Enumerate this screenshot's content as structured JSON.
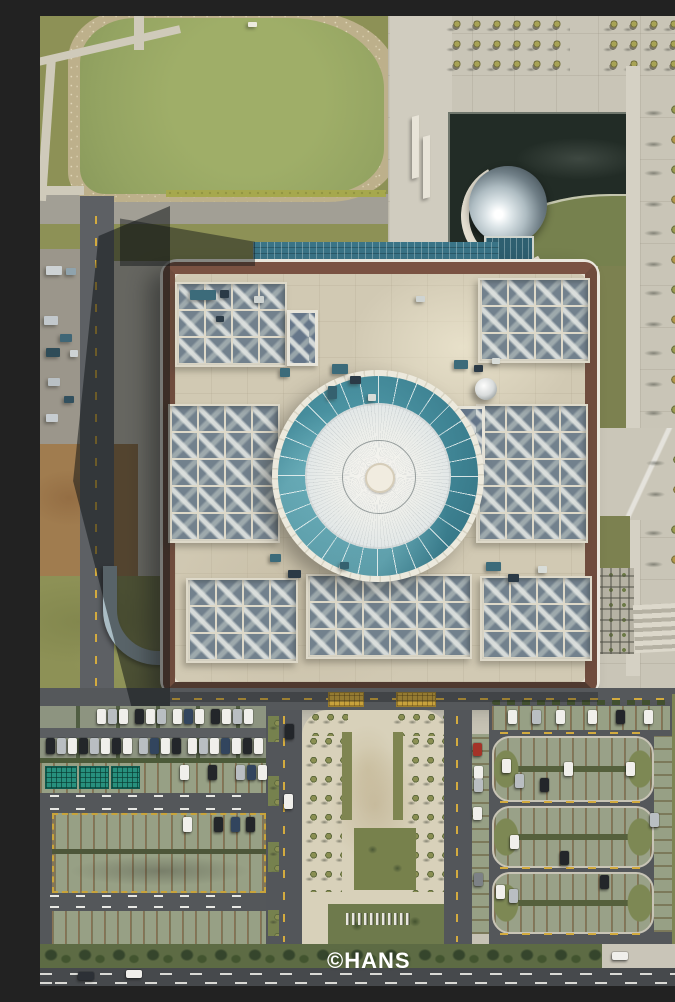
{
  "meta": {
    "type": "aerial-drone-photograph",
    "view": "top-down",
    "description": "Top-down aerial photograph of a large square museum building with a circular teal glass ring and white domed skylight at its center, a mirrored sphere in a dark reflecting pool at its north-east corner, a green pond to the north-west, tree-lined plazas, and large parking lots with grass-paver stalls to the south.",
    "width_px": 675,
    "height_px": 970
  },
  "watermark": {
    "text": "©HANS",
    "color": "#ffffff"
  },
  "palette": {
    "pond_green": "#9aa865",
    "grass_olive": "#8a8f56",
    "plaza_light": "#cbc7b9",
    "roof_beige": "#d0c8b2",
    "parapet_brown": "#5e4338",
    "dome_teal": "#3d7f8e",
    "dome_white": "#edeeea",
    "pool_dark": "#222c26",
    "sphere_silver": "#c3ced3",
    "asphalt_gray": "#54575a",
    "paver_green_gray": "#98a086",
    "stripe_pink": "#c48870",
    "hedge_dark_green": "#4c5a39",
    "autumn_tree_gold": "#b3974a",
    "road_marking_yellow": "#d3ab3f",
    "road_marking_white": "#e8e8e4"
  },
  "scene": {
    "cars": [
      [
        57,
        693,
        9,
        15,
        "#f0efeb"
      ],
      [
        68,
        693,
        9,
        15,
        "#b9bec2"
      ],
      [
        79,
        693,
        9,
        15,
        "#f0efeb"
      ],
      [
        95,
        693,
        9,
        15,
        "#23262a"
      ],
      [
        106,
        693,
        9,
        15,
        "#f0efeb"
      ],
      [
        117,
        693,
        9,
        15,
        "#b9bec2"
      ],
      [
        133,
        693,
        9,
        15,
        "#f0efeb"
      ],
      [
        144,
        693,
        9,
        15,
        "#32455e"
      ],
      [
        155,
        693,
        9,
        15,
        "#f0efeb"
      ],
      [
        171,
        693,
        9,
        15,
        "#23262a"
      ],
      [
        182,
        693,
        9,
        15,
        "#f0efeb"
      ],
      [
        193,
        693,
        9,
        15,
        "#b9bec2"
      ],
      [
        204,
        693,
        9,
        15,
        "#f0efeb"
      ],
      [
        6,
        722,
        9,
        16,
        "#23262a"
      ],
      [
        17,
        722,
        9,
        16,
        "#b9bec2"
      ],
      [
        28,
        722,
        9,
        16,
        "#f0efeb"
      ],
      [
        39,
        722,
        9,
        16,
        "#23262a"
      ],
      [
        50,
        722,
        9,
        16,
        "#b9bec2"
      ],
      [
        61,
        722,
        9,
        16,
        "#f0efeb"
      ],
      [
        72,
        722,
        9,
        16,
        "#23262a"
      ],
      [
        83,
        722,
        9,
        16,
        "#f0efeb"
      ],
      [
        99,
        722,
        9,
        16,
        "#b9bec2"
      ],
      [
        110,
        722,
        9,
        16,
        "#32455e"
      ],
      [
        121,
        722,
        9,
        16,
        "#f0efeb"
      ],
      [
        132,
        722,
        9,
        16,
        "#23262a"
      ],
      [
        148,
        722,
        9,
        16,
        "#f0efeb"
      ],
      [
        159,
        722,
        9,
        16,
        "#b9bec2"
      ],
      [
        170,
        722,
        9,
        16,
        "#f0efeb"
      ],
      [
        181,
        722,
        9,
        16,
        "#32455e"
      ],
      [
        192,
        722,
        9,
        16,
        "#f0efeb"
      ],
      [
        203,
        722,
        9,
        16,
        "#23262a"
      ],
      [
        214,
        722,
        9,
        16,
        "#f0efeb"
      ],
      [
        140,
        749,
        9,
        15,
        "#f0efeb"
      ],
      [
        168,
        749,
        9,
        15,
        "#23262a"
      ],
      [
        196,
        749,
        9,
        15,
        "#b9bec2"
      ],
      [
        207,
        749,
        9,
        15,
        "#32455e"
      ],
      [
        218,
        749,
        9,
        15,
        "#f0efeb"
      ],
      [
        143,
        801,
        9,
        15,
        "#f0efeb"
      ],
      [
        174,
        801,
        9,
        15,
        "#23262a"
      ],
      [
        191,
        801,
        9,
        15,
        "#32455e"
      ],
      [
        206,
        801,
        9,
        15,
        "#23262a"
      ],
      [
        245,
        708,
        9,
        15,
        "#23262a"
      ],
      [
        244,
        778,
        9,
        15,
        "#f0efeb"
      ],
      [
        433,
        727,
        9,
        13,
        "#a33328"
      ],
      [
        434,
        750,
        9,
        13,
        "#f0efeb"
      ],
      [
        434,
        763,
        9,
        13,
        "#b9bec2"
      ],
      [
        433,
        791,
        9,
        13,
        "#f0efeb"
      ],
      [
        434,
        857,
        9,
        13,
        "#7c8186"
      ],
      [
        468,
        694,
        9,
        14,
        "#f0efeb"
      ],
      [
        492,
        694,
        9,
        14,
        "#b9bec2"
      ],
      [
        516,
        694,
        9,
        14,
        "#f0efeb"
      ],
      [
        548,
        694,
        9,
        14,
        "#f0efeb"
      ],
      [
        576,
        694,
        9,
        14,
        "#23262a"
      ],
      [
        604,
        694,
        9,
        14,
        "#f0efeb"
      ],
      [
        462,
        743,
        9,
        14,
        "#f0efeb"
      ],
      [
        475,
        758,
        9,
        14,
        "#b9bec2"
      ],
      [
        500,
        762,
        9,
        14,
        "#23262a"
      ],
      [
        524,
        746,
        9,
        14,
        "#f0efeb"
      ],
      [
        586,
        746,
        9,
        14,
        "#f0efeb"
      ],
      [
        470,
        819,
        9,
        14,
        "#f0efeb"
      ],
      [
        520,
        835,
        9,
        14,
        "#23262a"
      ],
      [
        456,
        869,
        9,
        14,
        "#f0efeb"
      ],
      [
        469,
        873,
        9,
        14,
        "#b9bec2"
      ],
      [
        560,
        859,
        9,
        14,
        "#23262a"
      ],
      [
        610,
        797,
        9,
        14,
        "#b9bec2"
      ],
      [
        86,
        954,
        16,
        8,
        "#f0efeb"
      ],
      [
        38,
        956,
        16,
        8,
        "#2c3036"
      ],
      [
        572,
        936,
        16,
        8,
        "#f0efeb"
      ]
    ],
    "roof_equipment": [
      [
        150,
        274,
        26,
        10,
        "#3c6b7a"
      ],
      [
        180,
        274,
        9,
        8,
        "#2b3a46"
      ],
      [
        214,
        280,
        10,
        7,
        "#cfd4d2"
      ],
      [
        176,
        300,
        8,
        6,
        "#2b3a46"
      ],
      [
        240,
        352,
        10,
        9,
        "#3c6b7a"
      ],
      [
        292,
        348,
        16,
        10,
        "#3c6b7a"
      ],
      [
        310,
        360,
        11,
        8,
        "#2b3a46"
      ],
      [
        288,
        370,
        9,
        13,
        "#35616f"
      ],
      [
        328,
        378,
        8,
        7,
        "#d8dcd8"
      ],
      [
        414,
        344,
        14,
        9,
        "#3c6b7a"
      ],
      [
        434,
        349,
        9,
        7,
        "#2b3a46"
      ],
      [
        452,
        342,
        8,
        6,
        "#d8dcd8"
      ],
      [
        230,
        538,
        11,
        8,
        "#3c6b7a"
      ],
      [
        248,
        554,
        13,
        8,
        "#2b3a46"
      ],
      [
        300,
        546,
        9,
        7,
        "#35616f"
      ],
      [
        446,
        546,
        15,
        9,
        "#3c6b7a"
      ],
      [
        468,
        558,
        11,
        8,
        "#2b3a46"
      ],
      [
        498,
        550,
        9,
        7,
        "#d8dcd8"
      ],
      [
        376,
        280,
        9,
        6,
        "#cfd4d2"
      ],
      [
        6,
        250,
        16,
        9,
        "#cdd2d4"
      ],
      [
        26,
        252,
        10,
        7,
        "#8fa3ad"
      ],
      [
        4,
        300,
        14,
        9,
        "#c2c8cc"
      ],
      [
        20,
        318,
        12,
        8,
        "#3f6676"
      ],
      [
        6,
        332,
        14,
        9,
        "#2f4c58"
      ],
      [
        30,
        334,
        8,
        7,
        "#cdd2d4"
      ],
      [
        8,
        362,
        12,
        8,
        "#b9c0c4"
      ],
      [
        24,
        380,
        10,
        7,
        "#32505e"
      ],
      [
        6,
        398,
        12,
        8,
        "#c6ccd0"
      ],
      [
        208,
        6,
        9,
        5,
        "#eceadf"
      ]
    ]
  }
}
